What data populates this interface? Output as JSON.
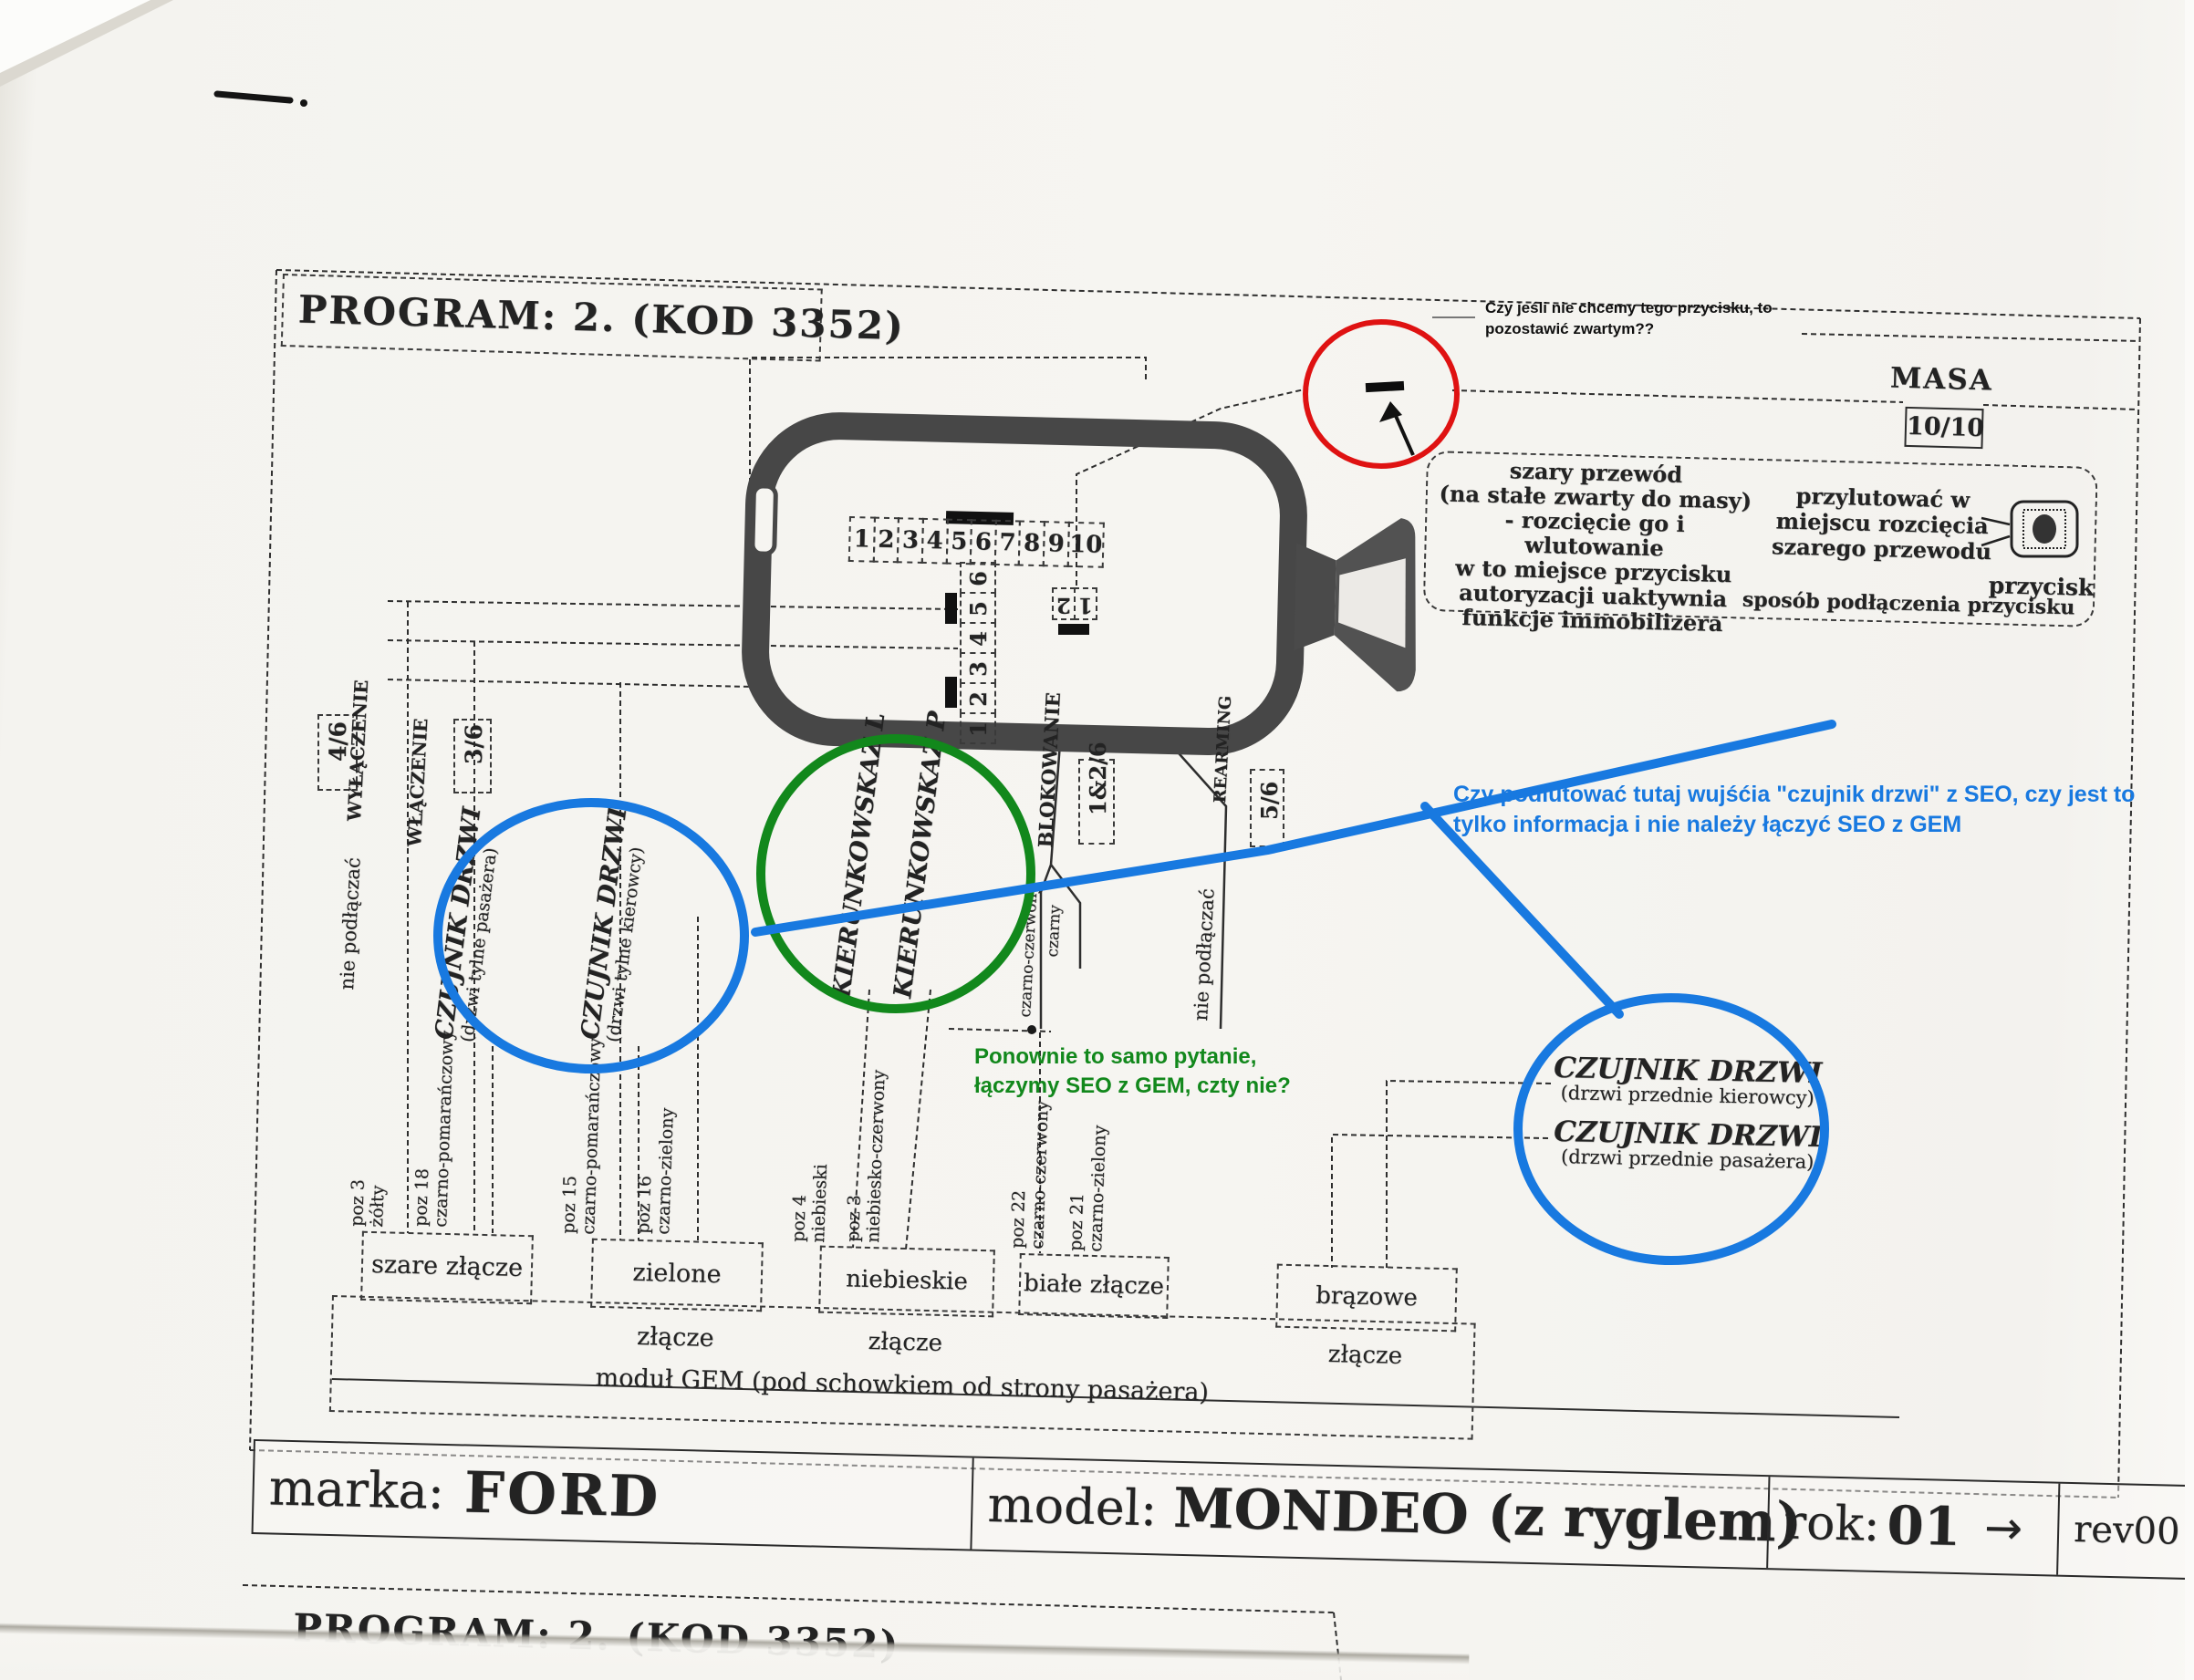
{
  "page": {
    "program_header": "PROGRAM:  2. (KOD 3352)",
    "program_footer": "PROGRAM:  2. (KOD 3352)"
  },
  "annotations": {
    "black_note": "Czy jeśli nie chcemy tego przycisku, to\npozostawić zwartym??",
    "blue_note": "Czy podlutować tutaj wujśćia \"czujnik drzwi\" z SEO, czy jest to\ntylko informacja i nie należy łączyć SEO z GEM",
    "green_note": "Ponownie to samo pytanie,\nłączymy SEO z GEM, czty nie?",
    "colors": {
      "red": "#df1212",
      "blue": "#1879e0",
      "green": "#12881c"
    }
  },
  "masa": {
    "label": "MASA",
    "pin": "10/10"
  },
  "info_box": {
    "left_text": "szary przewód\n(na stałe zwarty do masy)\n- rozcięcie go i wlutowanie\nw to miejsce przycisku\nautoryzacji uaktywnia\nfunkcje immobilizera",
    "right_text": "przylutować w\nmiejscu rozcięcia\nszarego przewodu",
    "button_label": "przycisk",
    "caption": "sposób podłączenia przycisku"
  },
  "connectors": {
    "pins10": [
      "1",
      "2",
      "3",
      "4",
      "5",
      "6",
      "7",
      "8",
      "9",
      "10"
    ],
    "pins6": [
      "6",
      "5",
      "4",
      "3",
      "2",
      "1"
    ],
    "pins2": [
      "2",
      "1"
    ]
  },
  "signals": {
    "wylaczenie": {
      "pin": "4/6",
      "label": "WYŁĄCZENIE"
    },
    "wlaczenie": {
      "pin": "3/6",
      "label": "WŁĄCZENIE"
    },
    "blokowanie": {
      "pin": "1&2/6",
      "label": "BLOKOWANIE"
    },
    "rearming": {
      "pin": "5/6",
      "label": "REARMING"
    },
    "nie_podlaczac_left": "nie podłączać",
    "nie_podlaczac_right": "nie podłączać",
    "czarno_czerwony": "czarno-czerwony",
    "czarny": "czarny"
  },
  "door_sensors": {
    "rear_passenger": {
      "title": "CZUJNIK DRZWI",
      "sub": "(drzwi tylne pasażera)"
    },
    "rear_driver": {
      "title": "CZUJNIK DRZWI",
      "sub": "(drzwi tylne kierowcy)"
    },
    "front_driver": {
      "title": "CZUJNIK DRZWI",
      "sub": "(drzwi przednie kierowcy)"
    },
    "front_passenger": {
      "title": "CZUJNIK DRZWI",
      "sub": "(drzwi przednie pasażera)"
    }
  },
  "turn_signals": {
    "left": "KIERUNKOWSKAZ L",
    "right": "KIERUNKOWSKAZ P"
  },
  "wire_positions": [
    {
      "pos": "poz 3",
      "color": "żółty"
    },
    {
      "pos": "poz 18",
      "color": "czarno-pomarańczowy"
    },
    {
      "pos": "poz 15",
      "color": "czarno-pomarańczowy"
    },
    {
      "pos": "poz 16",
      "color": "czarno-zielony"
    },
    {
      "pos": "poz 4",
      "color": "niebieski"
    },
    {
      "pos": "poz 3",
      "color": "niebiesko-czerwony"
    },
    {
      "pos": "poz 22",
      "color": "czarno-czerwony"
    },
    {
      "pos": "poz 21",
      "color": "czarno-zielony"
    }
  ],
  "connector_boxes": [
    {
      "label": "szare złącze"
    },
    {
      "label": "zielone złącze"
    },
    {
      "label": "niebieskie złącze"
    },
    {
      "label": "białe złącze"
    },
    {
      "label": "brązowe złącze"
    }
  ],
  "gem_module": "moduł GEM (pod schowkiem od strony pasażera)",
  "title_bar": {
    "marka_label": "marka:",
    "marka_value": "FORD",
    "model_label": "model:",
    "model_value": "MONDEO (z ryglem)",
    "rok_label": "rok:",
    "rok_value": "01",
    "rok_arrow": "→",
    "rev": "rev00"
  }
}
